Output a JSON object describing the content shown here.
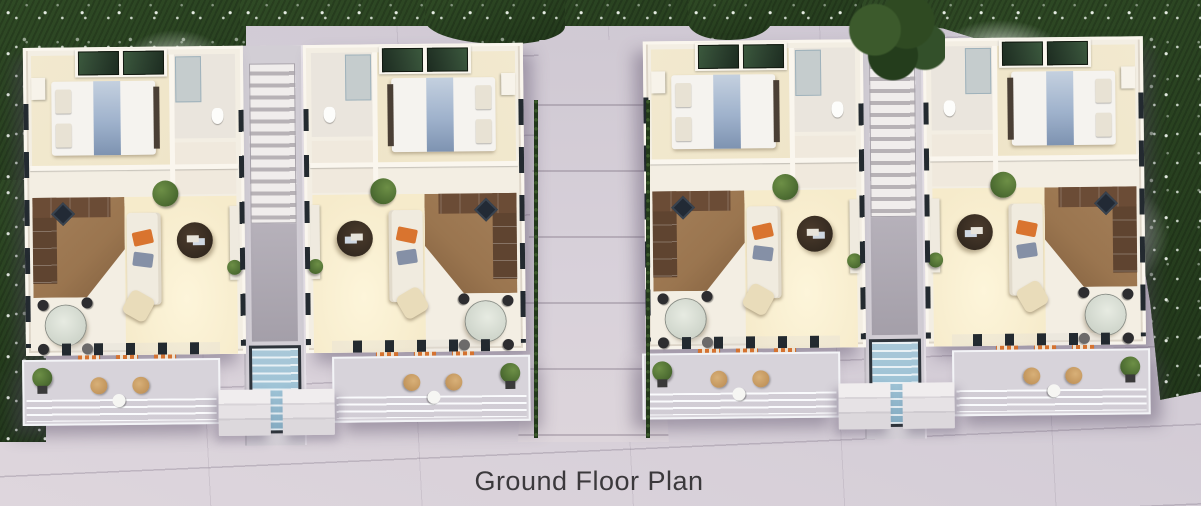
{
  "caption": "Ground Floor Plan",
  "scene": {
    "units": [
      {
        "id": "unit-1",
        "variant": "A"
      },
      {
        "id": "unit-2",
        "variant": "B"
      },
      {
        "id": "unit-3",
        "variant": "A"
      },
      {
        "id": "unit-4",
        "variant": "B"
      }
    ]
  },
  "colors": {
    "paving": "#d3ccd6",
    "grass": "#2f4a25",
    "flower": "#e9efe5",
    "wall": "#f3eee3",
    "floor-warm": "#f6ebcb",
    "kitchen-floor": "#9a754f",
    "cabinet": "#5f4430",
    "cooktop": "#222a35",
    "bed-runner": "#9fb2cc",
    "sofa": "#f0ebdf",
    "cushion-orange": "#d9742f",
    "cushion-blue": "#8590a6",
    "table-dark": "#342a20",
    "pouf": "#e9dcba",
    "plant": "#4f6f33",
    "glass-wardrobe": "#2e4431",
    "skylight": "#9ec3d6",
    "wicker": "#c2955c",
    "deck": "#d7d3da",
    "caption": "#3b393c"
  }
}
